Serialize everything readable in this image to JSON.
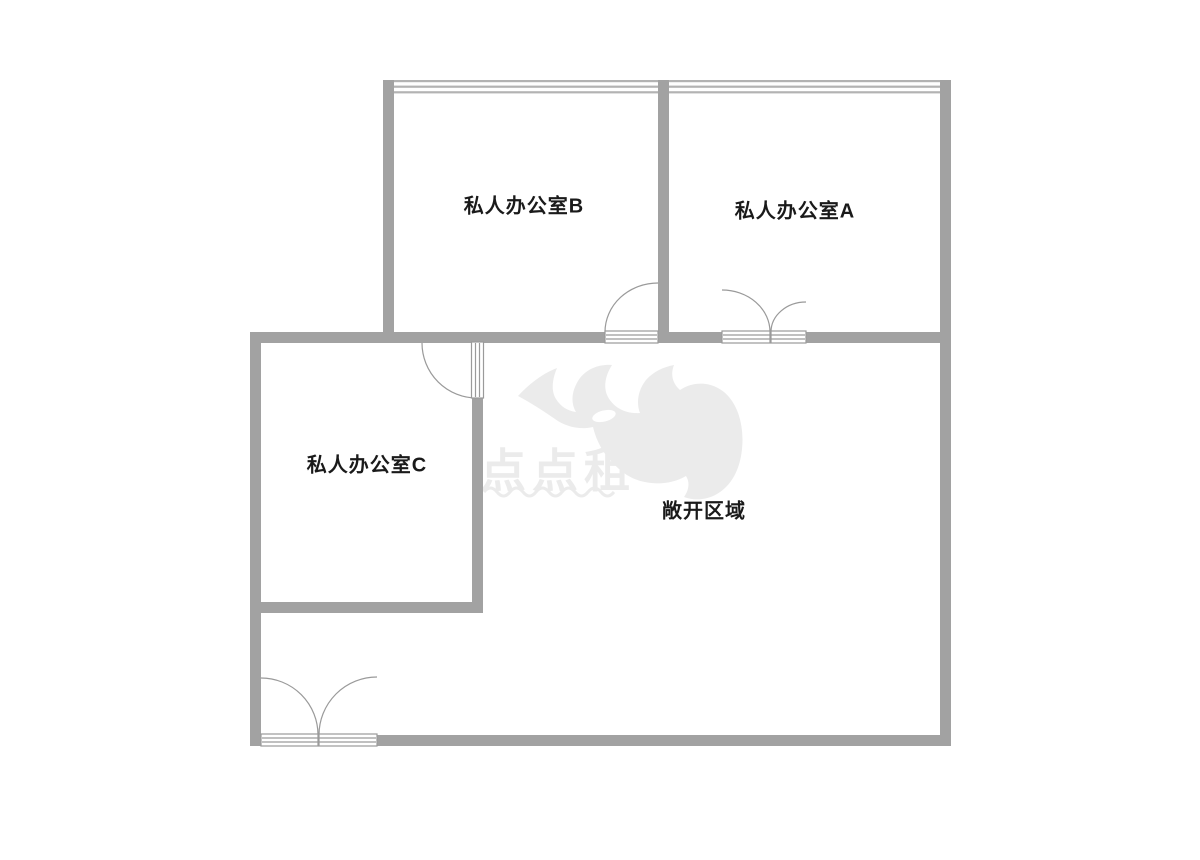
{
  "page": {
    "background_color": "#ffffff"
  },
  "floorplan": {
    "wall_color": "#a2a2a2",
    "window_line_color": "#b3b3b3",
    "door_line_color": "#9a9a9a",
    "label_color": "#1a1a1a",
    "watermark_color": "#ebebeb",
    "rooms": [
      {
        "id": "private-office-b",
        "label": "私人办公室B"
      },
      {
        "id": "private-office-a",
        "label": "私人办公室A"
      },
      {
        "id": "private-office-c",
        "label": "私人办公室C"
      },
      {
        "id": "open-area",
        "label": "敞开区域"
      }
    ],
    "watermark": {
      "text": "点点租",
      "logo": "rhino-logo",
      "color": "#ebebeb"
    }
  }
}
